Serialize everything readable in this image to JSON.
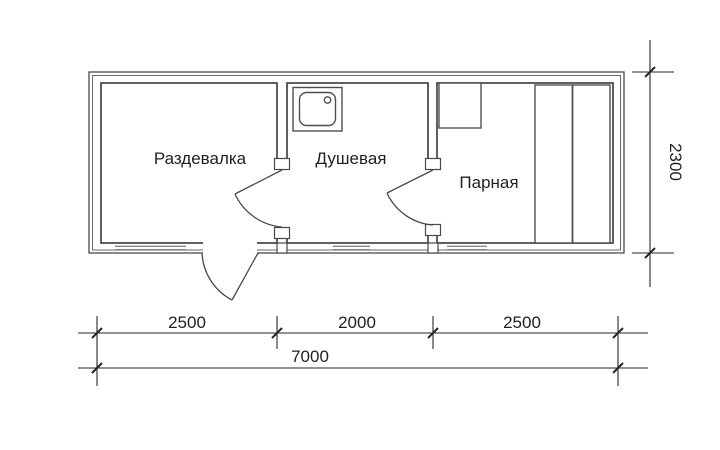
{
  "floor_plan": {
    "rooms": [
      {
        "label": "Раздевалка"
      },
      {
        "label": "Душевая"
      },
      {
        "label": "Парная"
      }
    ],
    "fixtures": [
      {
        "name": "shower-tray"
      },
      {
        "name": "stove"
      },
      {
        "name": "two-tier-bench"
      }
    ],
    "doors": [
      {
        "name": "entrance-door"
      },
      {
        "name": "door-razdevalka-dushevaya"
      },
      {
        "name": "door-dushevaya-parnaya"
      }
    ],
    "dimensions": {
      "bottom_segments": [
        "2500",
        "2000",
        "2500"
      ],
      "bottom_total": "7000",
      "right_height": "2300"
    },
    "colors": {
      "background": "#ffffff",
      "wall_line": "#4a4a4a",
      "dimension_line": "#262626",
      "text": "#1f1f1f"
    }
  }
}
